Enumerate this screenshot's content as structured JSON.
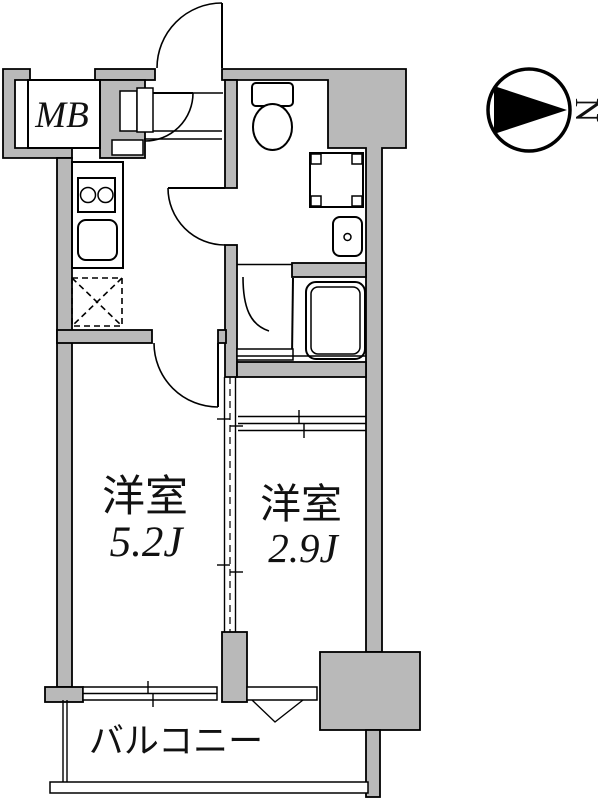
{
  "title": "apartment-floor-plan",
  "colors": {
    "wall_fill": "#b9b9b9",
    "line": "#000000",
    "background": "#ffffff"
  },
  "compass": {
    "label": "N"
  },
  "labels": {
    "meter_box": "MB",
    "room1_name": "洋室",
    "room1_size": "5.2J",
    "room2_name": "洋室",
    "room2_size": "2.9J",
    "balcony": "バルコニー"
  },
  "rooms": [
    {
      "name": "洋室",
      "size": "5.2J"
    },
    {
      "name": "洋室",
      "size": "2.9J"
    }
  ],
  "fixtures": [
    "entrance-door",
    "hall-inner-door",
    "shoe-cabinet",
    "meter-box",
    "kitchen-counter",
    "stove-2-burner",
    "kitchen-sink",
    "refrigerator-space",
    "toilet",
    "washing-machine-pan",
    "wash-basin",
    "bathtub",
    "bathroom-door",
    "washroom-door",
    "room-sliding-partition",
    "closet-sliding-door",
    "balcony-window",
    "small-window",
    "balcony",
    "north-compass"
  ]
}
